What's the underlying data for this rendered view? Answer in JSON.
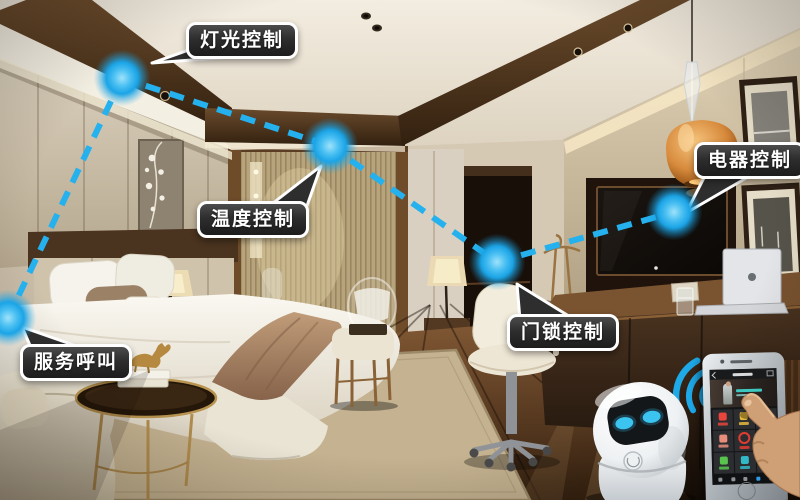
{
  "scene_colors": {
    "accent_blue": "#1ba4e6",
    "callout_bg": "#2e2e2e",
    "callout_border": "#ffffff",
    "robot_eye": "#3cc4f0"
  },
  "callouts": {
    "light": {
      "label": "灯光控制"
    },
    "temperature": {
      "label": "温度控制"
    },
    "appliance": {
      "label": "电器控制"
    },
    "doorlock": {
      "label": "门锁控制"
    },
    "service": {
      "label": "服务呼叫"
    }
  },
  "phone": {
    "tiles": [
      {
        "icon": "bell-icon",
        "color": "#e8463c",
        "shape": "square"
      },
      {
        "icon": "broom-icon",
        "color": "#e6b83c",
        "shape": "square"
      },
      {
        "icon": "leaf-icon",
        "color": "#66c24a",
        "shape": "square"
      },
      {
        "icon": "chat-icon",
        "color": "#e88d7a",
        "shape": "square"
      },
      {
        "icon": "do-not-disturb-icon",
        "color": "#e03c30",
        "shape": "circle"
      },
      {
        "icon": "clock-icon",
        "color": "#2fc4b2",
        "shape": "circle"
      },
      {
        "icon": "washer-icon",
        "color": "#58c44e",
        "shape": "square"
      },
      {
        "icon": "iron-icon",
        "color": "#32b8c6",
        "shape": "square"
      },
      {
        "icon": "more-icon",
        "color": "#3a7a6e",
        "shape": "square"
      }
    ],
    "nav": {
      "count": 5,
      "active_index": 3,
      "active_color": "#2e9ae8",
      "idle_color": "#8d9296"
    }
  }
}
